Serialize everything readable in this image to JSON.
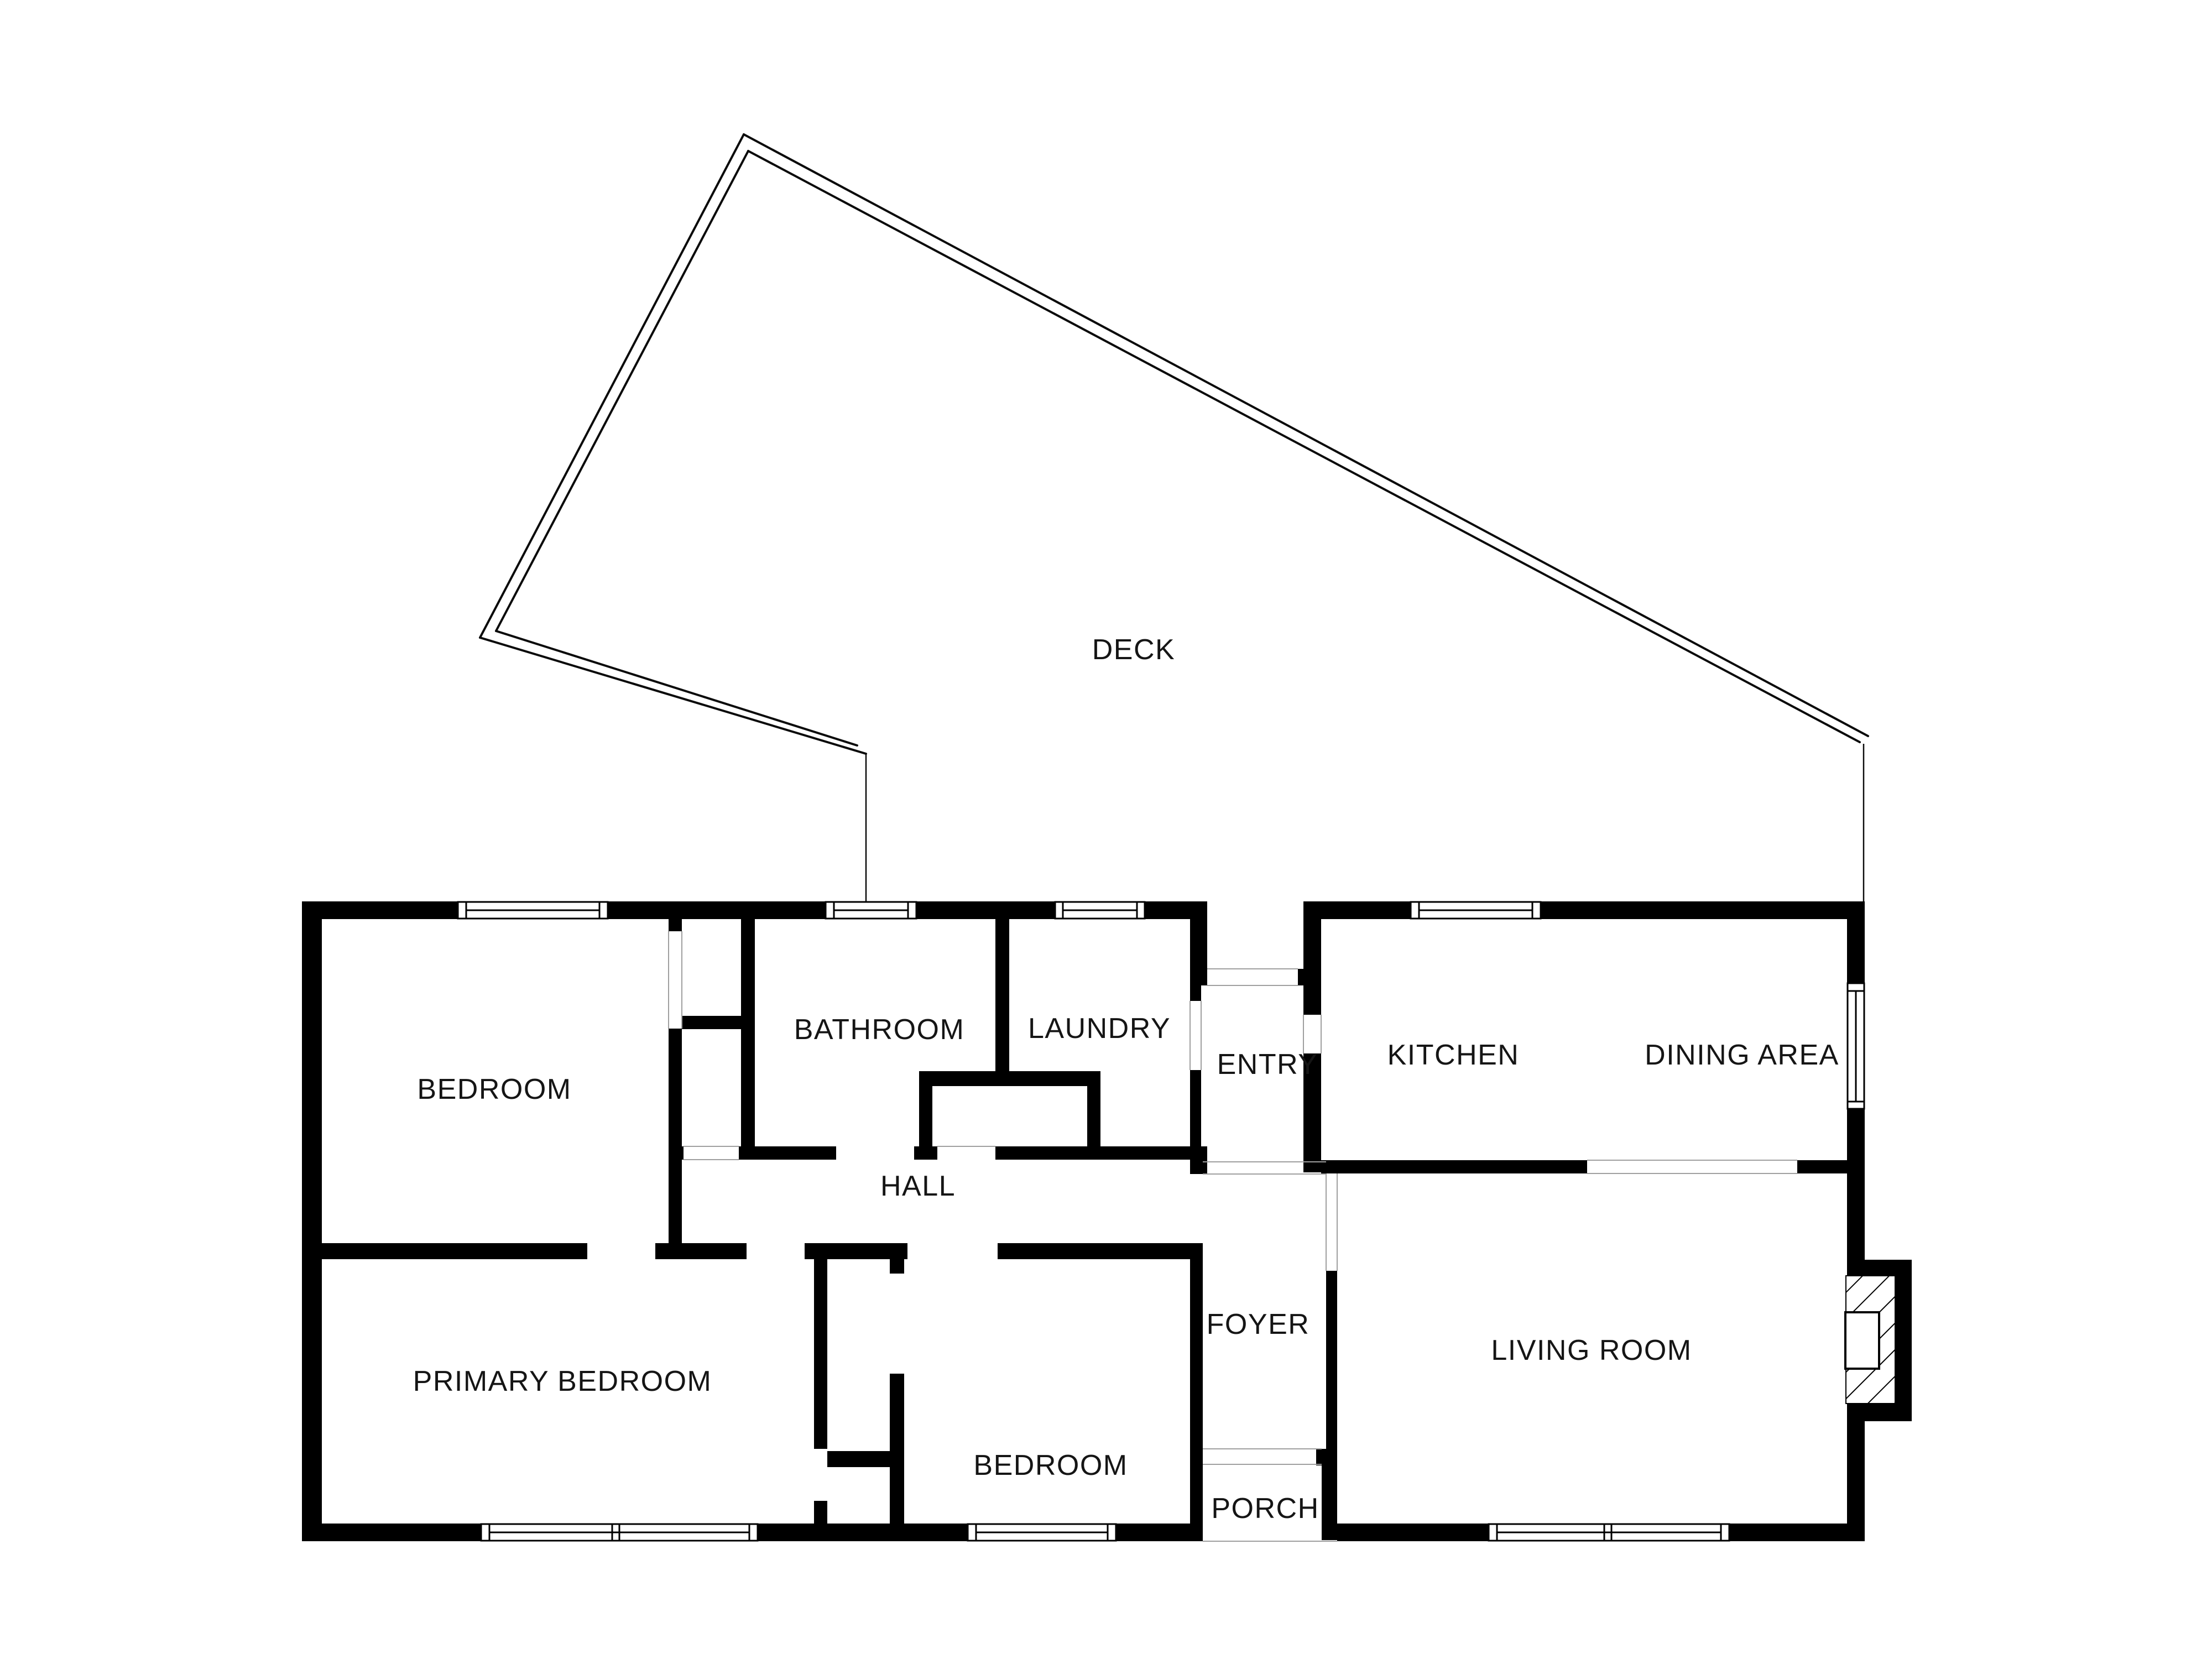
{
  "title": "Floor plan",
  "colors": {
    "background": "#ffffff",
    "wall": "#000000",
    "deck_line": "#0a0a0a",
    "label": "#151515",
    "threshold": "#9f9f9f"
  },
  "floor_plan": {
    "rooms": [
      {
        "id": "deck",
        "label": "DECK"
      },
      {
        "id": "bedroom-top",
        "label": "BEDROOM"
      },
      {
        "id": "bathroom",
        "label": "BATHROOM"
      },
      {
        "id": "laundry",
        "label": "LAUNDRY"
      },
      {
        "id": "entry",
        "label": "ENTRY"
      },
      {
        "id": "kitchen",
        "label": "KITCHEN"
      },
      {
        "id": "dining-area",
        "label": "DINING AREA"
      },
      {
        "id": "hall",
        "label": "HALL"
      },
      {
        "id": "primary-bedroom",
        "label": "PRIMARY BEDROOM"
      },
      {
        "id": "bedroom-bottom",
        "label": "BEDROOM"
      },
      {
        "id": "foyer",
        "label": "FOYER"
      },
      {
        "id": "living-room",
        "label": "LIVING ROOM"
      },
      {
        "id": "porch",
        "label": "PORCH"
      }
    ],
    "features": [
      "fireplace",
      "deck",
      "porch-steps",
      "windows",
      "door-openings"
    ]
  }
}
